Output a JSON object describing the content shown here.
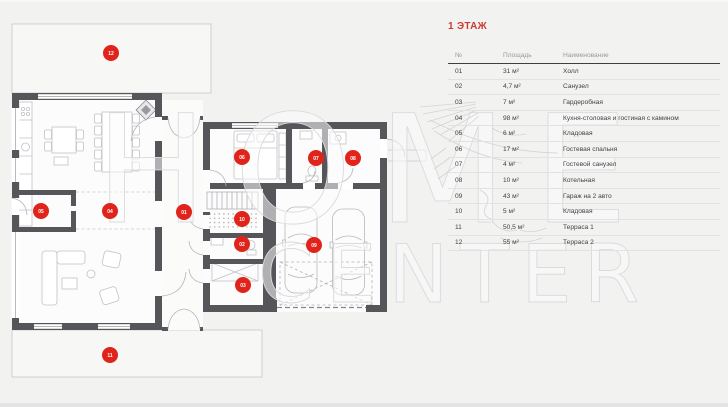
{
  "page": {
    "background": "#f2f2f1"
  },
  "legend": {
    "title": "1 ЭТАЖ",
    "title_color": "#cc3a33",
    "columns": [
      "№",
      "Площадь",
      "Наименование"
    ],
    "rows": [
      {
        "num": "01",
        "area": "31 м²",
        "name": "Холл"
      },
      {
        "num": "02",
        "area": "4,7 м²",
        "name": "Санузел"
      },
      {
        "num": "03",
        "area": "7 м²",
        "name": "Гардеробная"
      },
      {
        "num": "04",
        "area": "98 м²",
        "name": "Кухня-столовая и гостиная с камином"
      },
      {
        "num": "05",
        "area": "6 м²",
        "name": "Кладовая"
      },
      {
        "num": "06",
        "area": "17 м²",
        "name": "Гостевая спальня"
      },
      {
        "num": "07",
        "area": "4 м²",
        "name": "Гостевой санузел"
      },
      {
        "num": "08",
        "area": "10 м²",
        "name": "Котельная"
      },
      {
        "num": "09",
        "area": "43 м²",
        "name": "Гараж на 2 авто"
      },
      {
        "num": "10",
        "area": "5 м²",
        "name": "Кладовая"
      },
      {
        "num": "11",
        "area": "50,5 м²",
        "name": "Терраса 1"
      },
      {
        "num": "12",
        "area": "55 м²",
        "name": "Терраса 2"
      }
    ]
  },
  "plan": {
    "colors": {
      "accent": "#e1241b",
      "wall": "#56565a",
      "line": "#c3c3c7"
    },
    "watermark": {
      "line1": "HOME",
      "line2": "CENTER"
    },
    "markers": [
      {
        "label": "12",
        "x": 111,
        "y": 53
      },
      {
        "label": "05",
        "x": 41,
        "y": 211
      },
      {
        "label": "04",
        "x": 110,
        "y": 211
      },
      {
        "label": "01",
        "x": 184,
        "y": 212
      },
      {
        "label": "06",
        "x": 242,
        "y": 157
      },
      {
        "label": "07",
        "x": 316,
        "y": 158
      },
      {
        "label": "08",
        "x": 353,
        "y": 158
      },
      {
        "label": "10",
        "x": 242,
        "y": 219
      },
      {
        "label": "02",
        "x": 242,
        "y": 244
      },
      {
        "label": "03",
        "x": 243,
        "y": 285
      },
      {
        "label": "09",
        "x": 314,
        "y": 245
      },
      {
        "label": "11",
        "x": 110,
        "y": 355
      }
    ]
  }
}
